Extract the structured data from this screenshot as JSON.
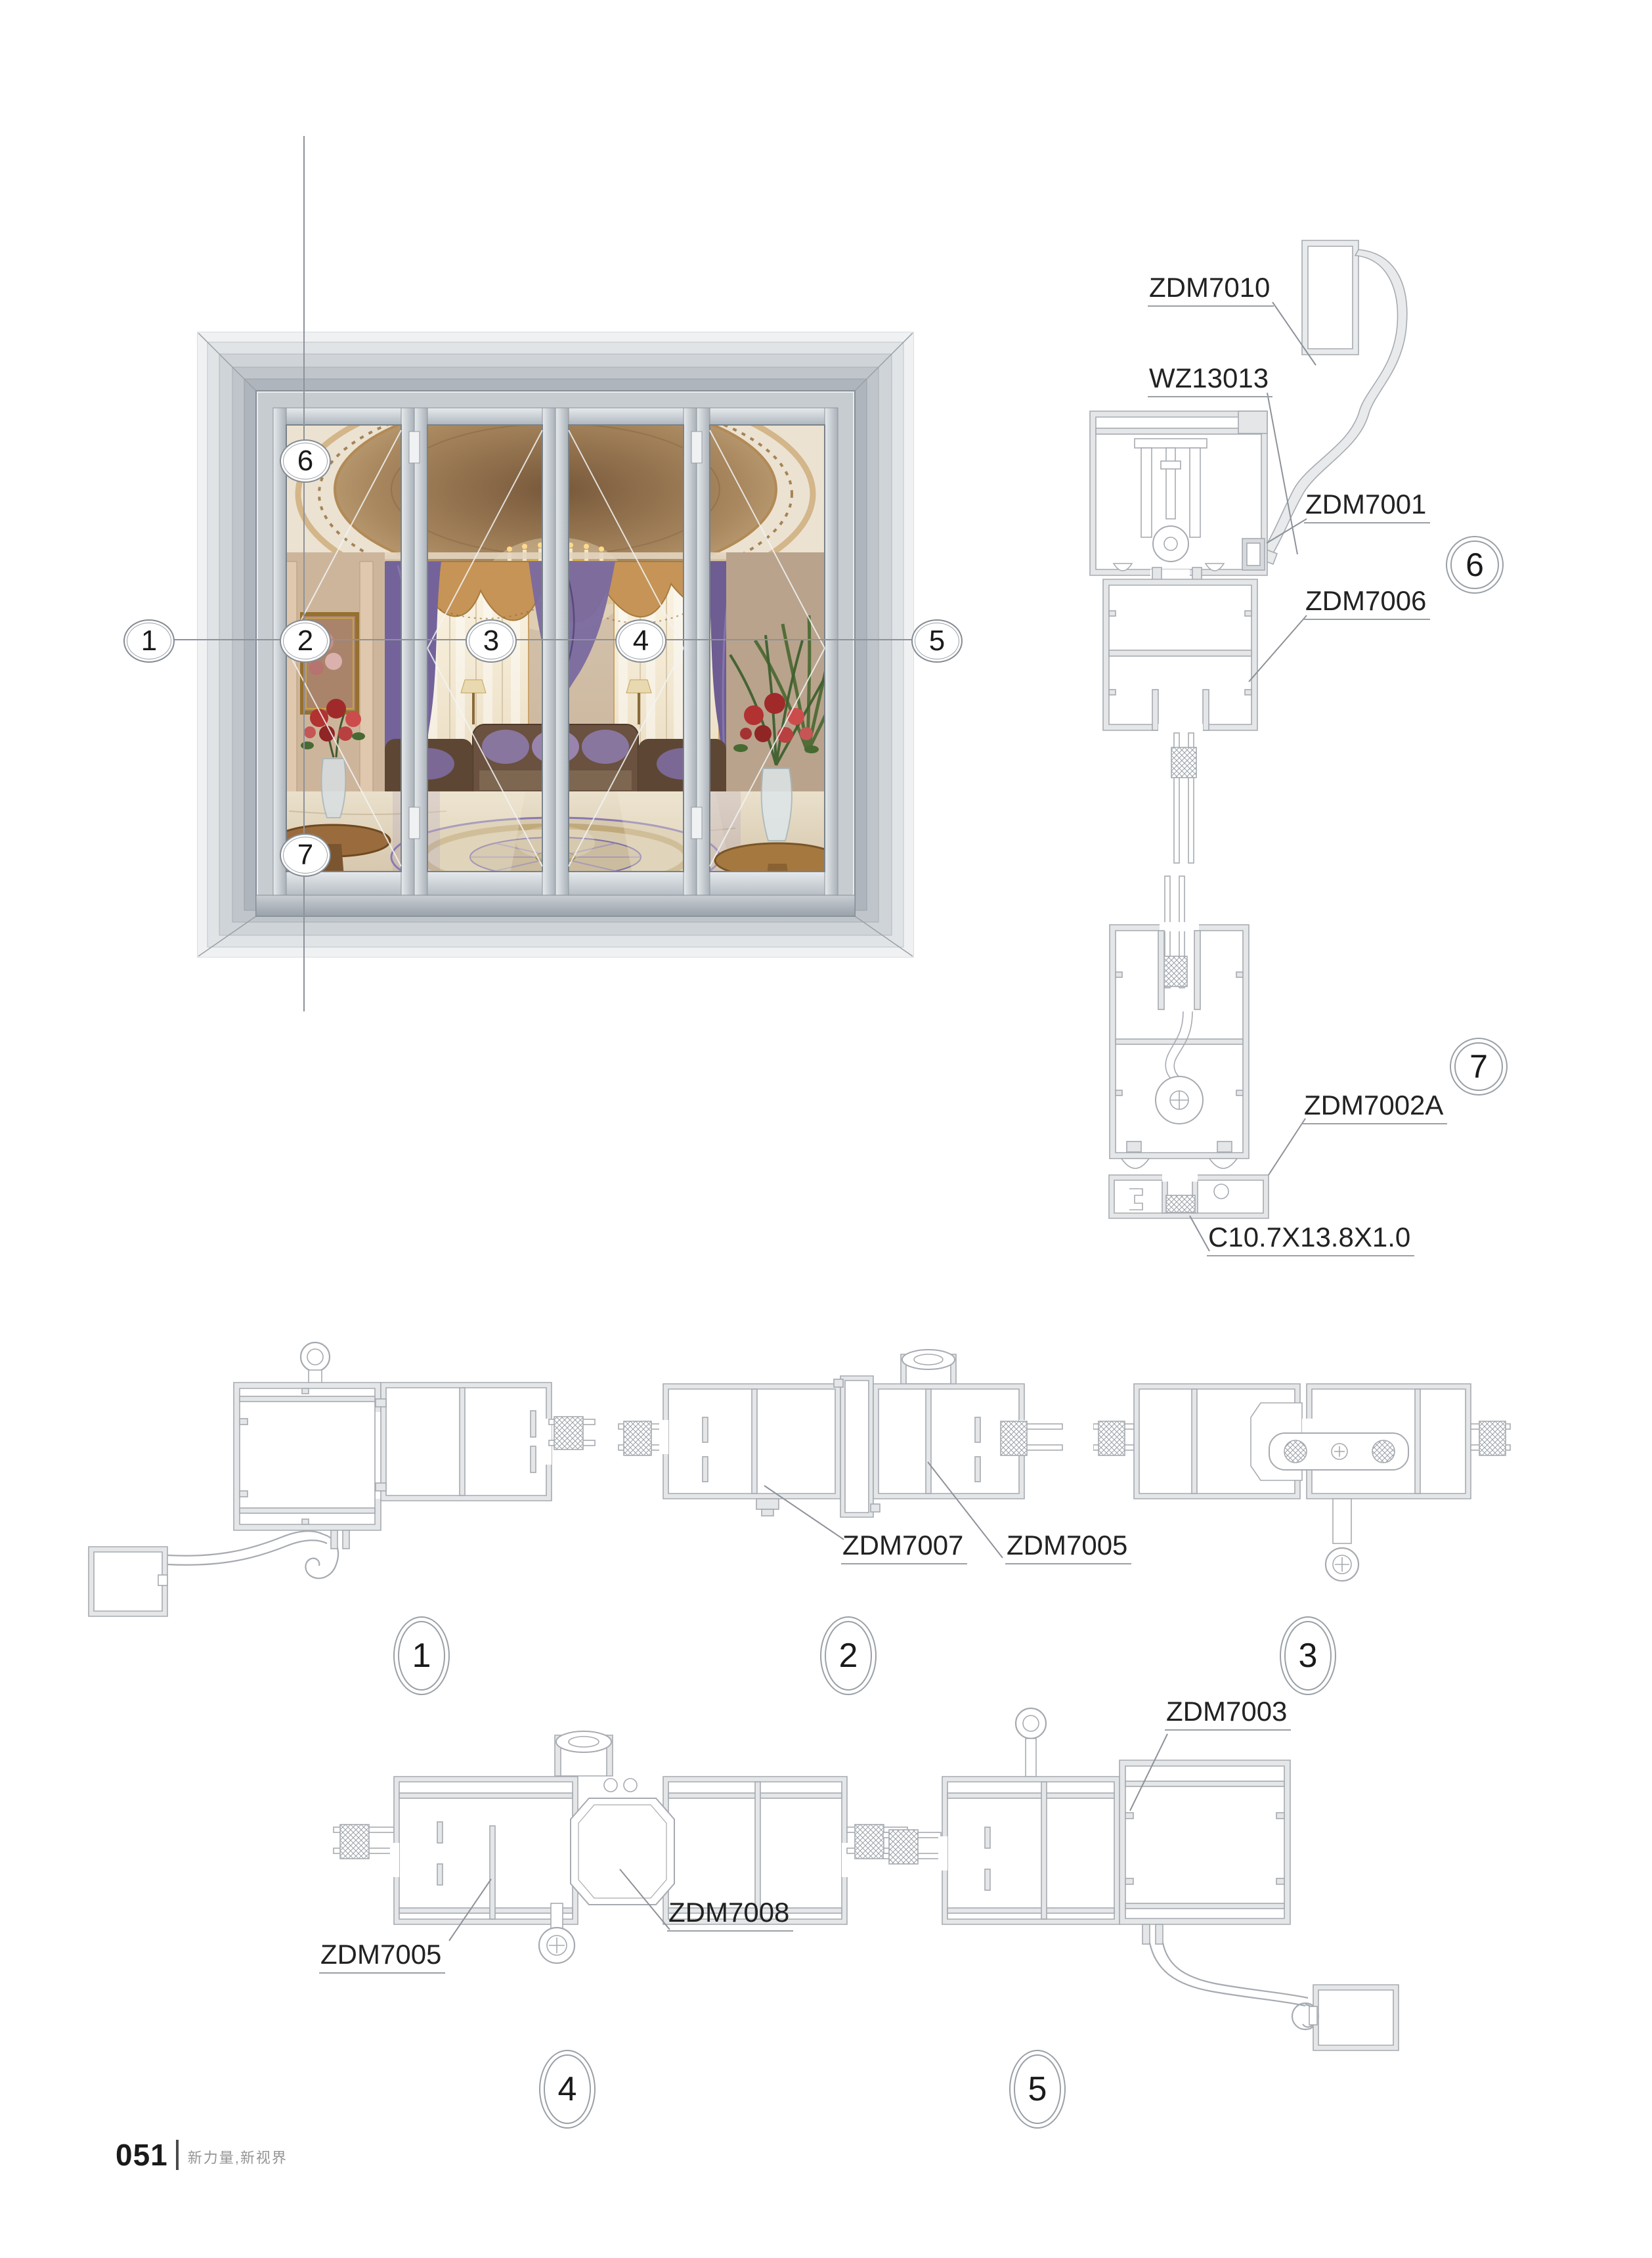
{
  "footer": {
    "page_number": "051",
    "tagline": "新力量,新视界"
  },
  "photo": {
    "description": "four-panel folding glass door elevation",
    "callouts": {
      "c1": "1",
      "c2": "2",
      "c3": "3",
      "c4": "4",
      "c5": "5",
      "c6": "6",
      "c7": "7"
    }
  },
  "sections": {
    "s1": {
      "num": "1"
    },
    "s2": {
      "num": "2",
      "label_left": "ZDM7007",
      "label_right": "ZDM7005"
    },
    "s3": {
      "num": "3"
    },
    "s4": {
      "num": "4",
      "label_left": "ZDM7005",
      "label_right": "ZDM7008"
    },
    "s5": {
      "num": "5",
      "label": "ZDM7003"
    },
    "s6": {
      "num": "6",
      "labels": {
        "cover": "ZDM7010",
        "insert": "WZ13013",
        "track": "ZDM7001",
        "rail": "ZDM7006"
      }
    },
    "s7": {
      "num": "7",
      "labels": {
        "threshold": "ZDM7002A",
        "channel": "C10.7X13.8X1.0"
      }
    }
  },
  "colors": {
    "drawing_line": "#a6abb1",
    "callout_line": "#8d9299",
    "label_text": "#222222",
    "tagline_text": "#949494"
  }
}
